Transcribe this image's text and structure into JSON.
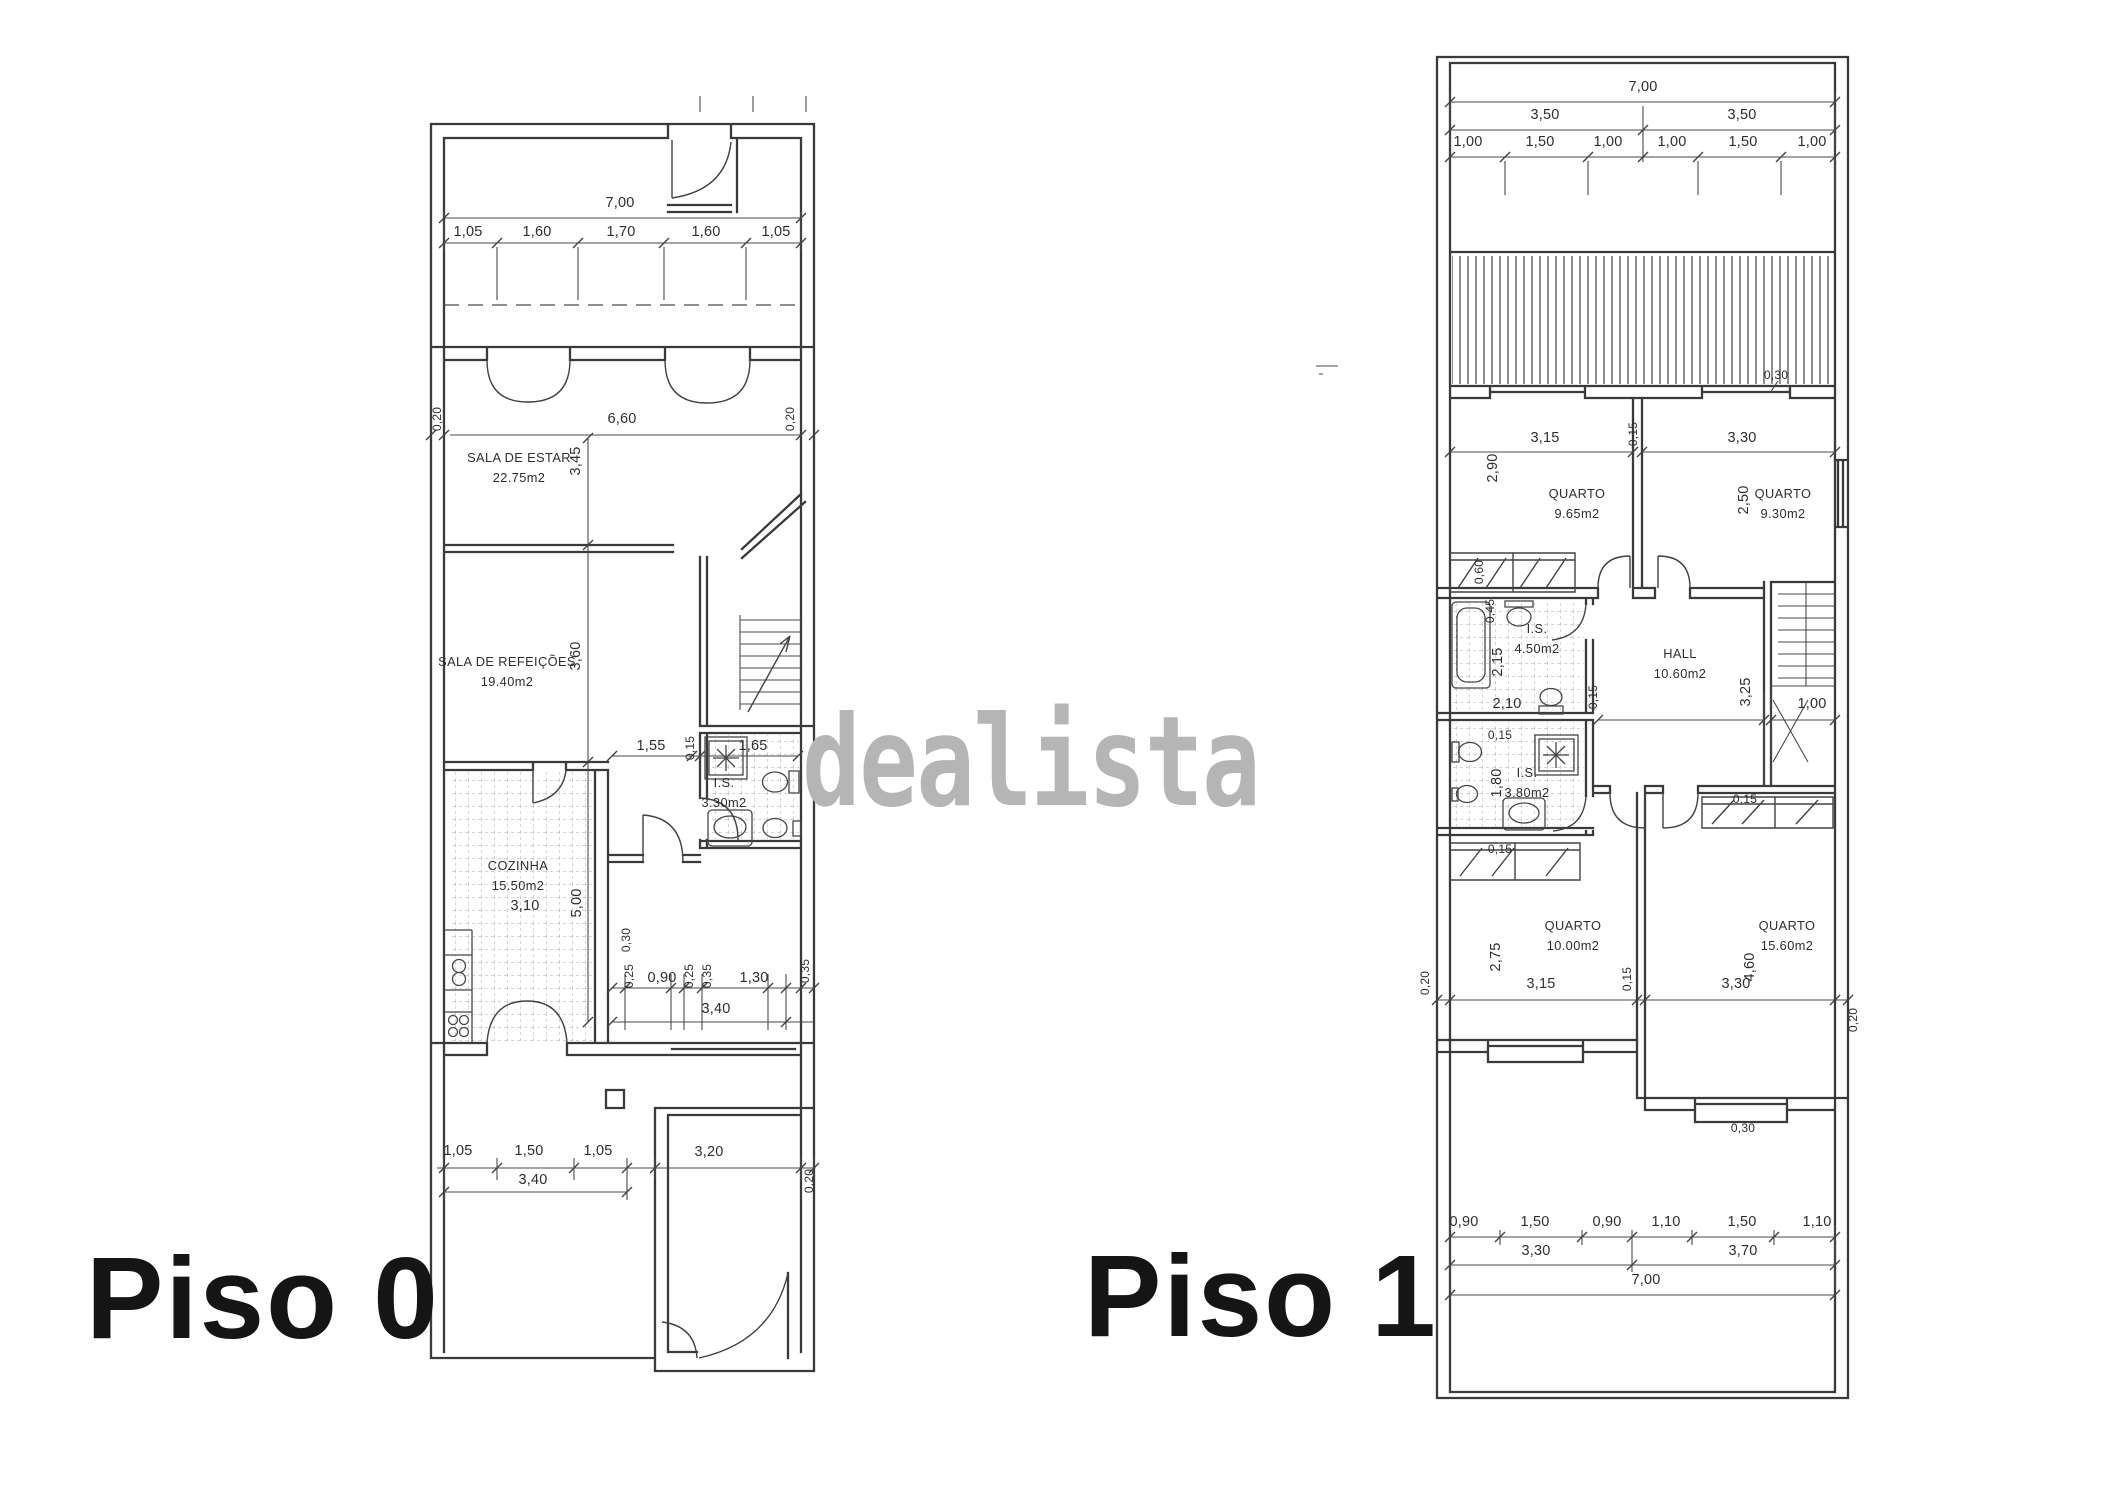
{
  "watermark": {
    "text": "dealista",
    "color": "#b5b5b5"
  },
  "ink_color": "#3a3a3a",
  "floors": [
    {
      "label": "Piso 0"
    },
    {
      "label": "Piso 1"
    }
  ],
  "plan0": {
    "rooms": [
      {
        "name": "SALA DE ESTAR",
        "area": "22.75m2",
        "x": 519,
        "y": 462
      },
      {
        "name": "SALA DE REFEIÇÕES",
        "area": "19.40m2",
        "x": 507,
        "y": 666
      },
      {
        "name": "COZINHA",
        "area": "15.50m2",
        "x": 518,
        "y": 870
      },
      {
        "name": "I.S.",
        "area": "3.30m2",
        "x": 724,
        "y": 787
      }
    ],
    "dims": [
      {
        "t": "7,00",
        "x": 620,
        "y": 207
      },
      {
        "t": "1,05",
        "x": 468,
        "y": 236
      },
      {
        "t": "1,60",
        "x": 537,
        "y": 236
      },
      {
        "t": "1,70",
        "x": 621,
        "y": 236
      },
      {
        "t": "1,60",
        "x": 706,
        "y": 236
      },
      {
        "t": "1,05",
        "x": 776,
        "y": 236
      },
      {
        "t": "0,20",
        "x": 441,
        "y": 419,
        "r": 1,
        "s": 1
      },
      {
        "t": "6,60",
        "x": 622,
        "y": 423
      },
      {
        "t": "0,20",
        "x": 794,
        "y": 419,
        "r": 1,
        "s": 1
      },
      {
        "t": "3,45",
        "x": 580,
        "y": 461,
        "r": 1
      },
      {
        "t": "3,60",
        "x": 580,
        "y": 656,
        "r": 1
      },
      {
        "t": "1,55",
        "x": 651,
        "y": 750
      },
      {
        "t": "0,15",
        "x": 694,
        "y": 748,
        "r": 1,
        "s": 1
      },
      {
        "t": "1,65",
        "x": 753,
        "y": 750
      },
      {
        "t": "5,00",
        "x": 581,
        "y": 903,
        "r": 1
      },
      {
        "t": "3,10",
        "x": 525,
        "y": 910
      },
      {
        "t": "0,30",
        "x": 630,
        "y": 940,
        "r": 1,
        "s": 1
      },
      {
        "t": "0,25",
        "x": 633,
        "y": 976,
        "r": 1,
        "s": 1
      },
      {
        "t": "0,90",
        "x": 662,
        "y": 982
      },
      {
        "t": "0,25",
        "x": 693,
        "y": 976,
        "r": 1,
        "s": 1
      },
      {
        "t": "0,35",
        "x": 711,
        "y": 976,
        "r": 1,
        "s": 1
      },
      {
        "t": "1,30",
        "x": 754,
        "y": 982
      },
      {
        "t": "0,35",
        "x": 809,
        "y": 971,
        "r": 1,
        "s": 1
      },
      {
        "t": "3,40",
        "x": 716,
        "y": 1013
      },
      {
        "t": "1,05",
        "x": 458,
        "y": 1155
      },
      {
        "t": "1,50",
        "x": 529,
        "y": 1155
      },
      {
        "t": "1,05",
        "x": 598,
        "y": 1155
      },
      {
        "t": "3,20",
        "x": 709,
        "y": 1156
      },
      {
        "t": "3,40",
        "x": 533,
        "y": 1184
      },
      {
        "t": "0,20",
        "x": 813,
        "y": 1181,
        "r": 1,
        "s": 1
      }
    ]
  },
  "plan1": {
    "rooms": [
      {
        "name": "QUARTO",
        "area": "9.65m2",
        "x": 1577,
        "y": 498
      },
      {
        "name": "QUARTO",
        "area": "9.30m2",
        "x": 1783,
        "y": 498
      },
      {
        "name": "HALL",
        "area": "10.60m2",
        "x": 1680,
        "y": 658
      },
      {
        "name": "I.S.",
        "area": "4.50m2",
        "x": 1537,
        "y": 633
      },
      {
        "name": "I.S.",
        "area": "3.80m2",
        "x": 1527,
        "y": 777
      },
      {
        "name": "QUARTO",
        "area": "10.00m2",
        "x": 1573,
        "y": 930
      },
      {
        "name": "QUARTO",
        "area": "15.60m2",
        "x": 1787,
        "y": 930
      }
    ],
    "dims": [
      {
        "t": "7,00",
        "x": 1643,
        "y": 91
      },
      {
        "t": "3,50",
        "x": 1545,
        "y": 119
      },
      {
        "t": "3,50",
        "x": 1742,
        "y": 119
      },
      {
        "t": "1,00",
        "x": 1468,
        "y": 146
      },
      {
        "t": "1,50",
        "x": 1540,
        "y": 146
      },
      {
        "t": "1,00",
        "x": 1608,
        "y": 146
      },
      {
        "t": "1,00",
        "x": 1672,
        "y": 146
      },
      {
        "t": "1,50",
        "x": 1743,
        "y": 146
      },
      {
        "t": "1,00",
        "x": 1812,
        "y": 146
      },
      {
        "t": "0,30",
        "x": 1776,
        "y": 379,
        "s": 1
      },
      {
        "t": "3,15",
        "x": 1545,
        "y": 442
      },
      {
        "t": "0,15",
        "x": 1637,
        "y": 434,
        "r": 1,
        "s": 1
      },
      {
        "t": "3,30",
        "x": 1742,
        "y": 442
      },
      {
        "t": "2,90",
        "x": 1497,
        "y": 468,
        "r": 1
      },
      {
        "t": "2,50",
        "x": 1748,
        "y": 500,
        "r": 1
      },
      {
        "t": "0,60",
        "x": 1483,
        "y": 572,
        "r": 1,
        "s": 1
      },
      {
        "t": "0,45",
        "x": 1494,
        "y": 611,
        "r": 1,
        "s": 1
      },
      {
        "t": "2,15",
        "x": 1502,
        "y": 662,
        "r": 1
      },
      {
        "t": "0,15",
        "x": 1597,
        "y": 697,
        "r": 1,
        "s": 1
      },
      {
        "t": "3,25",
        "x": 1750,
        "y": 692,
        "r": 1
      },
      {
        "t": "2,10",
        "x": 1507,
        "y": 708
      },
      {
        "t": "1,00",
        "x": 1812,
        "y": 708
      },
      {
        "t": "0,15",
        "x": 1500,
        "y": 739,
        "s": 1
      },
      {
        "t": "1,80",
        "x": 1501,
        "y": 783,
        "r": 1
      },
      {
        "t": "0,15",
        "x": 1745,
        "y": 803,
        "s": 1
      },
      {
        "t": "0,15",
        "x": 1500,
        "y": 853,
        "s": 1
      },
      {
        "t": "2,75",
        "x": 1500,
        "y": 957,
        "r": 1
      },
      {
        "t": "3,15",
        "x": 1541,
        "y": 988
      },
      {
        "t": "0,15",
        "x": 1631,
        "y": 979,
        "r": 1,
        "s": 1
      },
      {
        "t": "3,30",
        "x": 1736,
        "y": 988
      },
      {
        "t": "4,60",
        "x": 1754,
        "y": 967,
        "r": 1
      },
      {
        "t": "0,20",
        "x": 1429,
        "y": 983,
        "r": 1,
        "s": 1
      },
      {
        "t": "0,20",
        "x": 1857,
        "y": 1020,
        "r": 1,
        "s": 1
      },
      {
        "t": "0,30",
        "x": 1743,
        "y": 1132,
        "s": 1
      },
      {
        "t": "0,90",
        "x": 1464,
        "y": 1226
      },
      {
        "t": "1,50",
        "x": 1535,
        "y": 1226
      },
      {
        "t": "0,90",
        "x": 1607,
        "y": 1226
      },
      {
        "t": "1,10",
        "x": 1666,
        "y": 1226
      },
      {
        "t": "1,50",
        "x": 1742,
        "y": 1226
      },
      {
        "t": "1,10",
        "x": 1817,
        "y": 1226
      },
      {
        "t": "3,30",
        "x": 1536,
        "y": 1255
      },
      {
        "t": "3,70",
        "x": 1743,
        "y": 1255
      },
      {
        "t": "7,00",
        "x": 1646,
        "y": 1284
      }
    ]
  }
}
